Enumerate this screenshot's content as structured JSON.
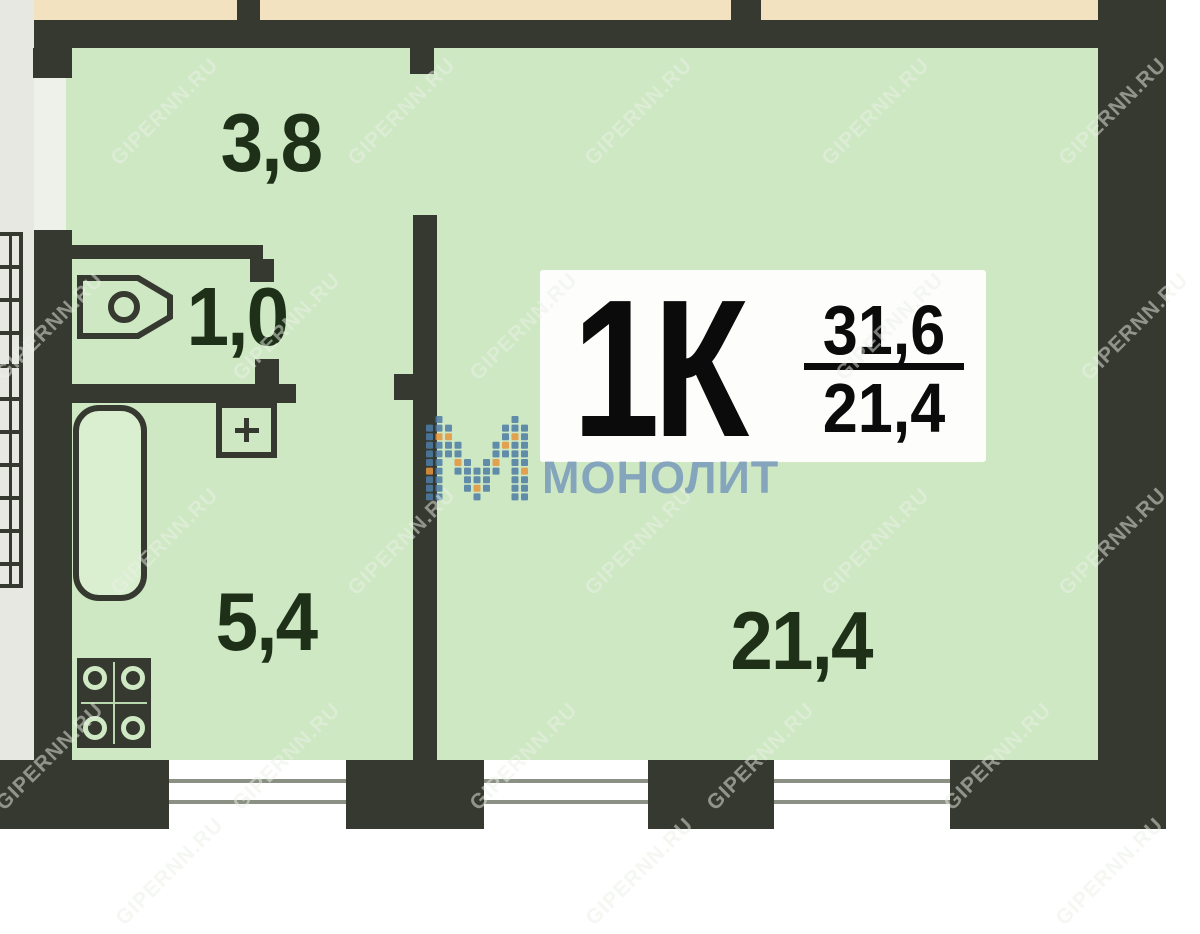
{
  "plan": {
    "apartment_type_label": "1К",
    "total_area": "31,6",
    "living_area": "21,4",
    "rooms": [
      {
        "id": "hallway",
        "area_label": "3,8"
      },
      {
        "id": "wc",
        "area_label": "1,0"
      },
      {
        "id": "kitchen",
        "area_label": "5,4"
      },
      {
        "id": "living-room",
        "area_label": "21,4"
      }
    ]
  },
  "branding": {
    "developer_logo_text": "МОНОЛИТ"
  },
  "watermark": {
    "text": "GIPERNN.RU"
  },
  "colors": {
    "room_fill": "#cde8c2",
    "wall": "#35392f",
    "adjacent_fill": "#f3e2c0",
    "outside_fill": "#e7e8e2",
    "label_text": "#1e3018",
    "logo_text": "#7fa0bd",
    "logo_blue": "#4d7ca6",
    "logo_orange": "#e6953e",
    "window_line": "#8a9083"
  }
}
